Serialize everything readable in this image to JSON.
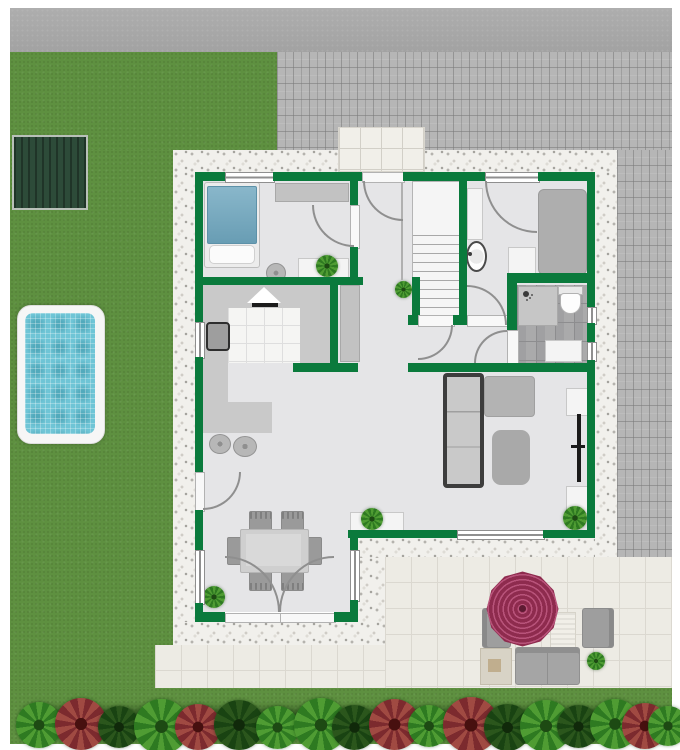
{
  "scene": {
    "type": "residential-floor-plan-with-garden",
    "canvas": {
      "width": 680,
      "height": 750
    }
  },
  "palette": {
    "wall": "#0a7a3c",
    "lawn": "#5e9040",
    "road": "#a9a9a9",
    "paver": "#b6b6b6",
    "gravel": "#f1f0ec",
    "patioTile": "#edebe4",
    "floor": "#e5e5e7",
    "bathTile": "#a0a0a2",
    "water": "#6fc5d6",
    "shed": "#2d4b39",
    "umbrella1": "#8e2b4e",
    "umbrella2": "#b8537a",
    "furnGray": "#c2c2c2",
    "counter": "#c9c9c9",
    "bedBlue": "#6fa7bf"
  },
  "house": {
    "rooms": [
      {
        "name": "bedroom",
        "furniture": [
          "double-bed-blue",
          "wardrobe",
          "round-stool",
          "sideboard",
          "plant"
        ]
      },
      {
        "name": "entry-hall",
        "furniture": [
          "tall-cabinet",
          "plant"
        ]
      },
      {
        "name": "staircase",
        "furniture": [
          "u-stair-with-winders",
          "railing"
        ]
      },
      {
        "name": "bedroom-2",
        "furniture": [
          "gray-bed",
          "tall-cabinet",
          "washbasin",
          "nightstand"
        ]
      },
      {
        "name": "bathroom",
        "furniture": [
          "shower",
          "toilet",
          "sink"
        ]
      },
      {
        "name": "kitchen",
        "furniture": [
          "l-counter",
          "kitchen-sink",
          "cooktop-hood",
          "bar-stool",
          "bar-stool"
        ]
      },
      {
        "name": "living-room",
        "furniture": [
          "corner-sofa",
          "chaise",
          "ottoman",
          "tv-unit",
          "bench-with-plant",
          "plant"
        ]
      },
      {
        "name": "dining-room",
        "furniture": [
          "dining-table",
          "chair",
          "chair",
          "chair",
          "chair",
          "chair",
          "chair",
          "plant"
        ]
      }
    ],
    "openings": [
      "front-door",
      "bedroom-door",
      "hall-door",
      "bedroom2-door",
      "vestibule-door",
      "bathroom-door",
      "side-door",
      "french-doors"
    ]
  },
  "outdoor": {
    "areas": [
      "road",
      "driveway-pavers",
      "lawn",
      "garden-shed",
      "swimming-pool",
      "gravel-border",
      "entry-walkway",
      "patio",
      "hedge-row"
    ],
    "patio_furniture": [
      "parasol",
      "armchair",
      "armchair",
      "lounger",
      "loveseat",
      "side-table",
      "potted-plant"
    ]
  },
  "garden": {
    "hedge_bushes": [
      {
        "x": 16,
        "y": 702,
        "s": 46,
        "c": "green"
      },
      {
        "x": 55,
        "y": 698,
        "s": 52,
        "c": "red"
      },
      {
        "x": 98,
        "y": 706,
        "s": 42,
        "c": "dark"
      },
      {
        "x": 134,
        "y": 699,
        "s": 55,
        "c": "green"
      },
      {
        "x": 175,
        "y": 704,
        "s": 46,
        "c": "red"
      },
      {
        "x": 214,
        "y": 700,
        "s": 50,
        "c": "dark"
      },
      {
        "x": 256,
        "y": 706,
        "s": 43,
        "c": "green"
      },
      {
        "x": 294,
        "y": 698,
        "s": 54,
        "c": "green"
      },
      {
        "x": 332,
        "y": 705,
        "s": 45,
        "c": "dark"
      },
      {
        "x": 369,
        "y": 699,
        "s": 51,
        "c": "red"
      },
      {
        "x": 408,
        "y": 705,
        "s": 42,
        "c": "green"
      },
      {
        "x": 443,
        "y": 697,
        "s": 56,
        "c": "red"
      },
      {
        "x": 484,
        "y": 704,
        "s": 47,
        "c": "dark"
      },
      {
        "x": 520,
        "y": 700,
        "s": 52,
        "c": "green"
      },
      {
        "x": 557,
        "y": 705,
        "s": 43,
        "c": "dark"
      },
      {
        "x": 590,
        "y": 699,
        "s": 50,
        "c": "green"
      },
      {
        "x": 622,
        "y": 703,
        "s": 46,
        "c": "red"
      },
      {
        "x": 648,
        "y": 706,
        "s": 40,
        "c": "green"
      }
    ]
  }
}
